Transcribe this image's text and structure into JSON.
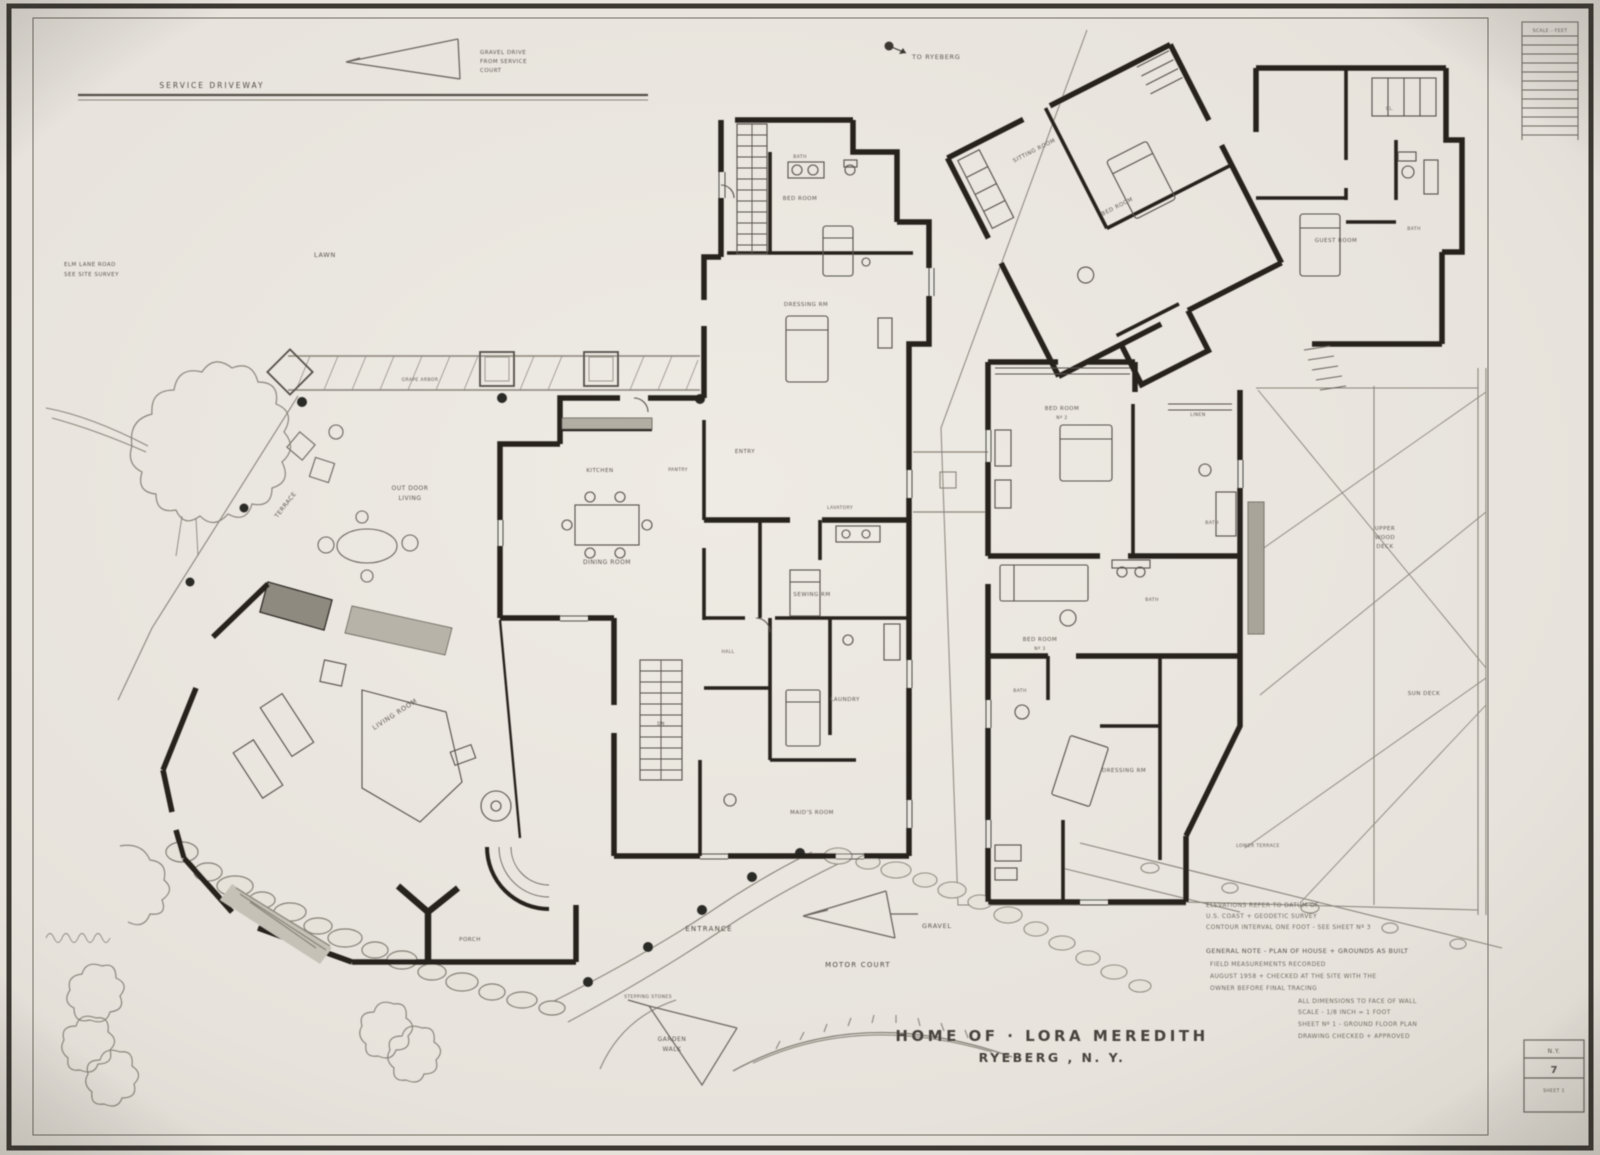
{
  "colors": {
    "paper": "#e9e5de",
    "ink": "#2b2823",
    "light_line": "#8a857b",
    "label": "#5c574f"
  },
  "sheet": {
    "title1": "HOME OF · LORA MEREDITH",
    "title2": "RYEBERG , N. Y.",
    "ruler": "SCALE - FEET",
    "stamp1": "N.Y.",
    "stamp2": "7",
    "stamp3": "SHEET 1"
  },
  "site": {
    "service_driveway": "SERVICE DRIVEWAY",
    "drive_note_1": "GRAVEL DRIVE",
    "drive_note_2": "FROM SERVICE",
    "drive_note_3": "COURT",
    "north_note": "TO RYEBERG",
    "road_note_1": "ELM LANE ROAD",
    "road_note_2": "SEE SITE SURVEY",
    "lawn": "LAWN",
    "arbor": "GRAPE ARBOR",
    "outdoor_1": "OUT DOOR",
    "outdoor_2": "LIVING",
    "terrace": "TERRACE",
    "entrance": "ENTRANCE",
    "stepping": "STEPPING STONES",
    "gravel": "GRAVEL",
    "motor_court": "MOTOR COURT",
    "garden_1": "GARDEN",
    "garden_2": "WALK",
    "lower_terrace": "LOWER TERRACE",
    "deck_1": "UPPER",
    "deck_2": "WOOD",
    "deck_3": "DECK",
    "sun_deck": "SUN DECK"
  },
  "left_house": {
    "bath1": "BATH",
    "bed1": "BED ROOM",
    "dress": "DRESSING RM",
    "entry": "ENTRY",
    "pantry": "PANTRY",
    "kitchen": "KITCHEN",
    "dining": "DINING ROOM",
    "lav": "LAVATORY",
    "sewing": "SEWING RM",
    "hall": "HALL",
    "stair": "DN",
    "laundry": "LAUNDRY",
    "maid": "MAID'S ROOM",
    "living": "LIVING ROOM",
    "porch": "PORCH"
  },
  "right_house": {
    "sitting": "SITTING ROOM",
    "bed_a": "BED ROOM",
    "guest": "GUEST ROOM",
    "bath_a": "BATH",
    "cl": "CL.",
    "bed2a": "BED ROOM",
    "bed2b": "Nº 2",
    "linen": "LINEN",
    "bath_b": "BATH",
    "bed3a": "BED ROOM",
    "bed3b": "Nº 3",
    "bath_c": "BATH",
    "dressing": "DRESSING RM",
    "bath_d": "BATH"
  },
  "credits": [
    "ELEVATIONS REFER TO DATUM OF",
    "U.S. COAST + GEODETIC SURVEY",
    "CONTOUR INTERVAL ONE FOOT - SEE SHEET Nº 3",
    "GENERAL NOTE - PLAN OF HOUSE + GROUNDS AS BUILT",
    "FIELD MEASUREMENTS RECORDED",
    "AUGUST 1958 + CHECKED AT THE SITE WITH THE",
    "OWNER BEFORE FINAL TRACING",
    "ALL DIMENSIONS TO FACE OF WALL",
    "SCALE - 1/8 INCH = 1 FOOT",
    "SHEET Nº 1 - GROUND FLOOR PLAN",
    "DRAWING CHECKED + APPROVED"
  ]
}
